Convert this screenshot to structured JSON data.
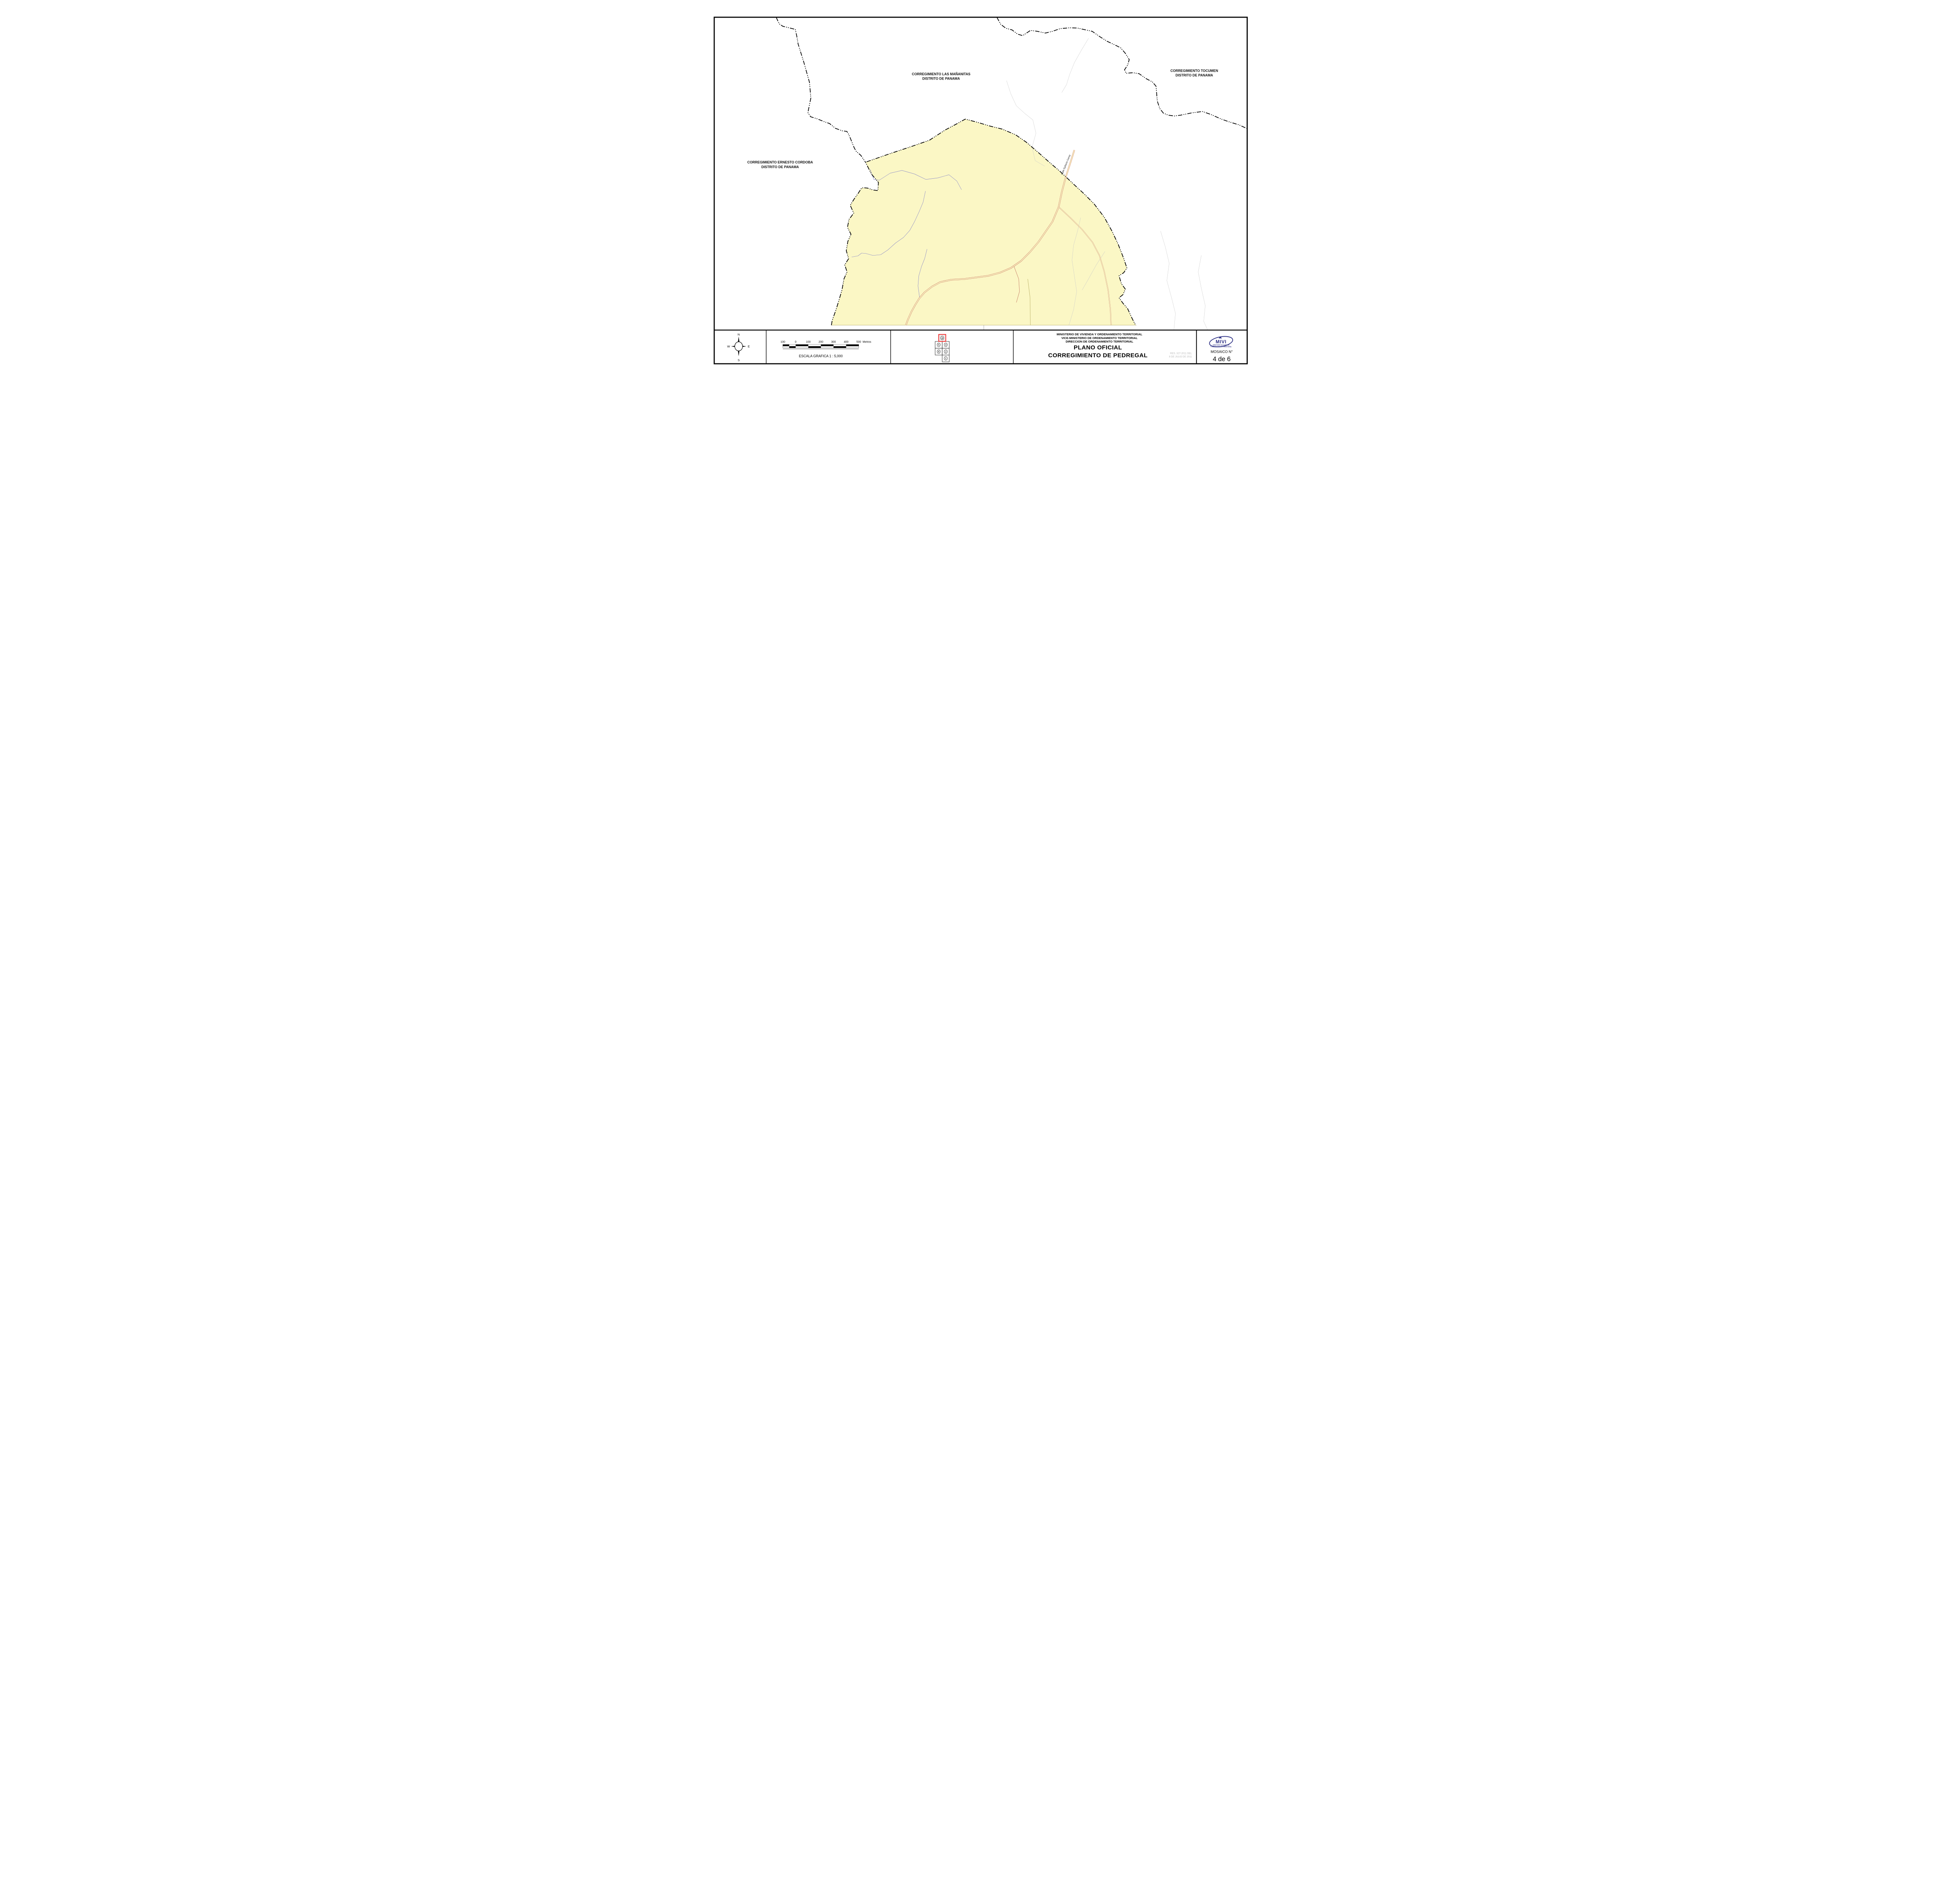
{
  "sheet": {
    "bg": "#ffffff",
    "frame_color": "#000000"
  },
  "map": {
    "region_fill": "#FBF7C5",
    "stream_color": "#7b7bc8",
    "road_color": "#b94a3c",
    "labels": {
      "mananitas_line1": "CORREGIMIENTO LAS MAÑANITAS",
      "mananitas_line2": "DISTRITO DE PANAMA",
      "tocumen_line1": "CORREGIMIENTO TOCUMEN",
      "tocumen_line2": "DISTRITO DE PANAMA",
      "ernesto_line1": "CORREGIMIENTO ERNESTO CORDOBA",
      "ernesto_line2": "DISTRITO DE PANAMA",
      "road": "Calle Epifanio Garay"
    }
  },
  "footer": {
    "compass": {
      "n": "N",
      "s": "S",
      "e": "E",
      "w": "W"
    },
    "scalebar": {
      "labels": [
        "100",
        "0",
        "100",
        "200",
        "300",
        "400",
        "500"
      ],
      "unit": "Metros",
      "caption": "ESCALA  GRAFICA  1 : 5,000"
    },
    "mosaic": {
      "tile_top": "4",
      "tile_r2c1": "5",
      "tile_r2c2": "3",
      "tile_r3c1": "6",
      "tile_r3c2": "2",
      "tile_r4c2": "1",
      "highlight_color": "#ee1c1c"
    },
    "ministry": {
      "line1": "MINISTERIO DE VIVIENDA Y ORDENAMIENTO TERRITORIAL",
      "line2": "VICE-MINISTERIO DE ORDENAMIENTO TERRITORIAL",
      "line3": "DIRECCION DE ORDENAMIENTO TERRITORIAL",
      "title1": "PLANO OFICIAL",
      "title2": "CORREGIMIENTO DE PEDREGAL",
      "res1": "RES. 327-2011 DEL",
      "res2": "8 DE JULIO DE 2011"
    },
    "logo": {
      "name": "MIVI",
      "sub1": "MINISTERIO DE VIVIENDA",
      "sub2": "Y ORDENAMIENTO TERRITORIAL",
      "color": "#2b2e83"
    },
    "mosaico": {
      "label": "MOSAICO N°",
      "number": "4 de 6"
    }
  }
}
